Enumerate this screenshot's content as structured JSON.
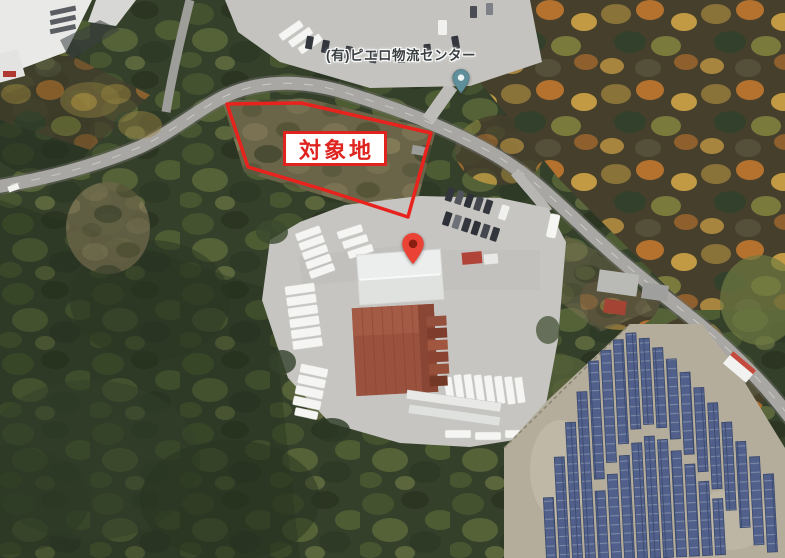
{
  "map": {
    "view_type": "satellite-aerial",
    "business_label": {
      "text": "(有)ピエロ物流センター",
      "text_color": "#3b4043",
      "halo_color": "#ffffff"
    },
    "business_pin": {
      "icon": "teardrop-pin-icon",
      "color": "#5f8f9b",
      "dot_color": "#edf3f2"
    },
    "location_pin": {
      "icon": "teardrop-pin-icon",
      "color": "#ea4335",
      "dot_color": "#8a1f11"
    },
    "target_site": {
      "label": "対象地",
      "boundary_color": "#e8231d",
      "label_text_color": "#df231f",
      "label_background": "#ffffff"
    },
    "terrain_palette": {
      "forest_green": "#35402b",
      "autumn_forest": "#8a6f38",
      "road_gray": "#a8a7a3",
      "yard_pavement": "#c6c5c1",
      "red_warehouse_roof": "#9a523f",
      "solar_panel_blue": "#51608a",
      "solar_ground_tan": "#b5ad9c"
    }
  }
}
